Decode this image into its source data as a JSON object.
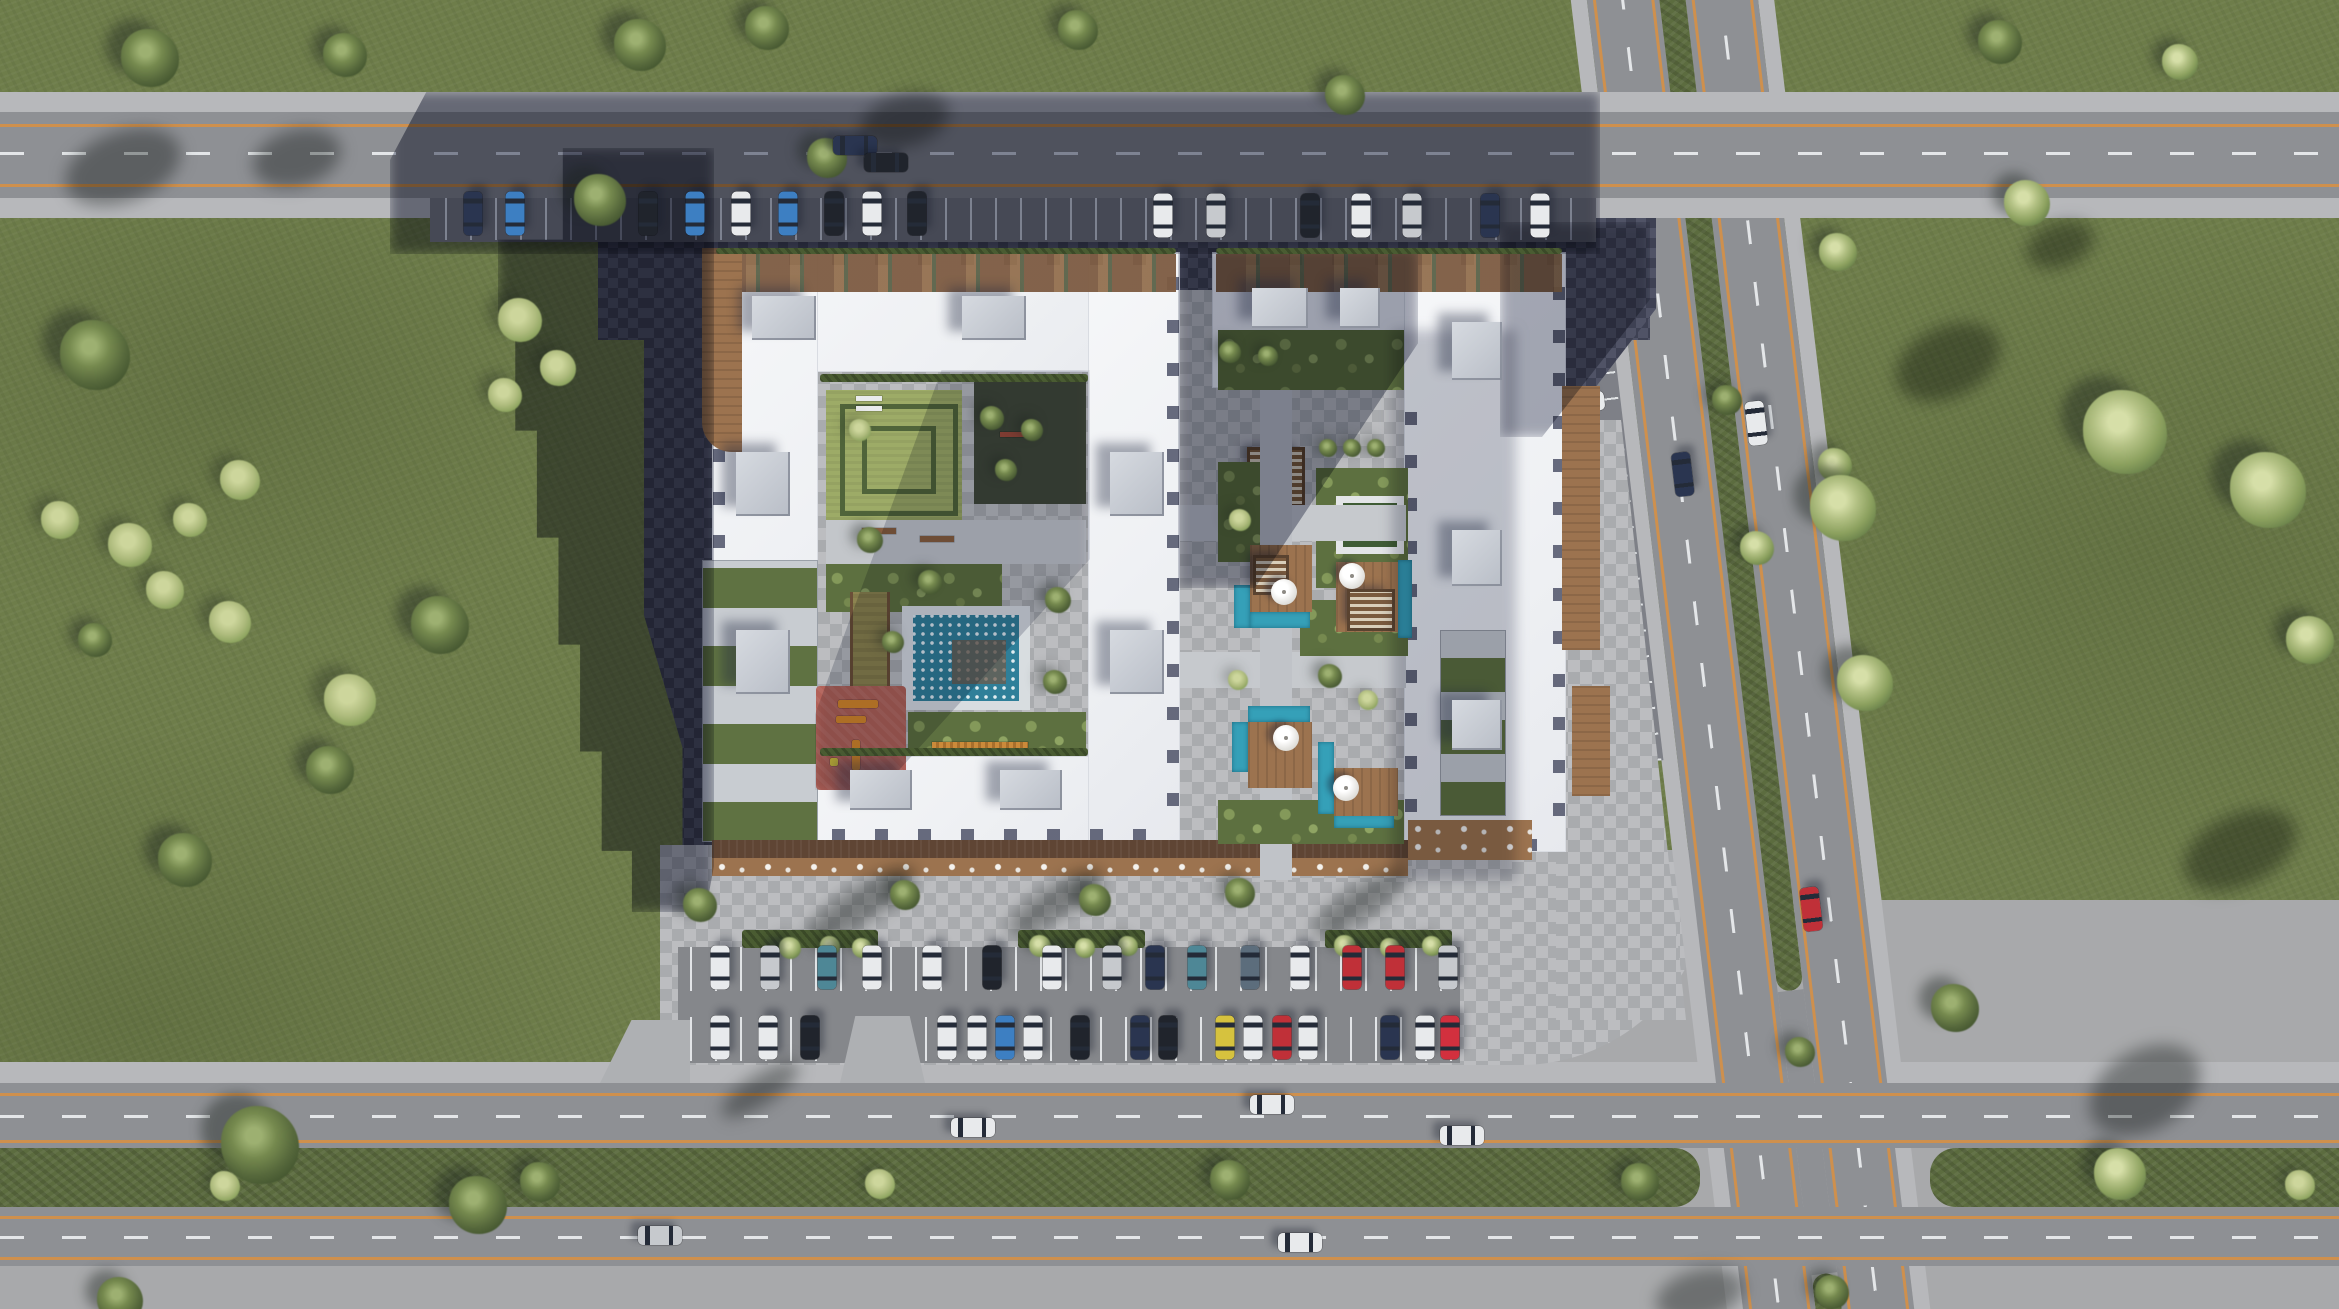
{
  "scene": {
    "description": "aerial top-down architectural render of a residential complex with two white-roofed perimeter buildings, landscaped courtyards with pools and playground, surface parking lots, and surrounding divided roads with green medians and lawns",
    "palette": {
      "grass": "#6e7d4a",
      "tree_dark": "#57693c",
      "tree_light": "#a3b273",
      "bush": "#c6cf92",
      "asphalt": "#8e9094",
      "line_orange": "#d59046",
      "line_white": "#edf0f2",
      "sidewalk": "#b7b8bb",
      "paver_light": "#b4b6b9",
      "paver_dark": "#45485c",
      "concrete": "#a8a9ab",
      "median_green": "#5c6c3f",
      "roof_white": "#f3f5f7",
      "roof_box": "#c8ccd3",
      "deck_wood": "#9c734f",
      "deck_dark": "#5f4534",
      "pool_water": "#2f7f99",
      "pool_bright": "#35a0b8",
      "hedge": "#4a5c32",
      "lawn": "#9dab67",
      "playground_red": "#b26158",
      "equipment_orange": "#d8882c",
      "track_olive": "#8d8450",
      "shadow_blue": "#272d48"
    },
    "trees": [
      {
        "x": 150,
        "y": 58,
        "s": 58,
        "t": "d"
      },
      {
        "x": 345,
        "y": 55,
        "s": 44,
        "t": "d"
      },
      {
        "x": 640,
        "y": 45,
        "s": 52,
        "t": "d"
      },
      {
        "x": 767,
        "y": 28,
        "s": 44,
        "t": "d"
      },
      {
        "x": 1078,
        "y": 30,
        "s": 40,
        "t": "d"
      },
      {
        "x": 1345,
        "y": 95,
        "s": 40,
        "t": "d"
      },
      {
        "x": 2000,
        "y": 42,
        "s": 44,
        "t": "d"
      },
      {
        "x": 2180,
        "y": 62,
        "s": 36,
        "t": "l"
      },
      {
        "x": 600,
        "y": 200,
        "s": 52,
        "t": "d"
      },
      {
        "x": 827,
        "y": 158,
        "s": 40,
        "t": "d"
      },
      {
        "x": 95,
        "y": 355,
        "s": 70,
        "t": "d"
      },
      {
        "x": 240,
        "y": 480,
        "s": 40,
        "t": "b"
      },
      {
        "x": 60,
        "y": 520,
        "s": 38,
        "t": "b"
      },
      {
        "x": 130,
        "y": 545,
        "s": 44,
        "t": "b"
      },
      {
        "x": 190,
        "y": 520,
        "s": 34,
        "t": "b"
      },
      {
        "x": 165,
        "y": 590,
        "s": 38,
        "t": "b"
      },
      {
        "x": 230,
        "y": 622,
        "s": 42,
        "t": "b"
      },
      {
        "x": 350,
        "y": 700,
        "s": 52,
        "t": "b"
      },
      {
        "x": 95,
        "y": 640,
        "s": 34,
        "t": "d"
      },
      {
        "x": 440,
        "y": 625,
        "s": 58,
        "t": "d"
      },
      {
        "x": 330,
        "y": 770,
        "s": 48,
        "t": "d"
      },
      {
        "x": 185,
        "y": 860,
        "s": 54,
        "t": "d"
      },
      {
        "x": 520,
        "y": 320,
        "s": 44,
        "t": "b"
      },
      {
        "x": 558,
        "y": 368,
        "s": 36,
        "t": "b"
      },
      {
        "x": 505,
        "y": 395,
        "s": 34,
        "t": "b"
      },
      {
        "x": 260,
        "y": 1145,
        "s": 78,
        "t": "d"
      },
      {
        "x": 478,
        "y": 1205,
        "s": 58,
        "t": "d"
      },
      {
        "x": 120,
        "y": 1300,
        "s": 46,
        "t": "d"
      },
      {
        "x": 2027,
        "y": 203,
        "s": 46,
        "t": "l"
      },
      {
        "x": 1838,
        "y": 252,
        "s": 38,
        "t": "l"
      },
      {
        "x": 1835,
        "y": 465,
        "s": 34,
        "t": "l"
      },
      {
        "x": 2125,
        "y": 432,
        "s": 84,
        "t": "l"
      },
      {
        "x": 2268,
        "y": 490,
        "s": 76,
        "t": "l"
      },
      {
        "x": 2310,
        "y": 640,
        "s": 48,
        "t": "l"
      },
      {
        "x": 1843,
        "y": 508,
        "s": 66,
        "t": "l"
      },
      {
        "x": 1865,
        "y": 683,
        "s": 56,
        "t": "l"
      },
      {
        "x": 1955,
        "y": 1008,
        "s": 48,
        "t": "d"
      },
      {
        "x": 225,
        "y": 1186,
        "s": 30,
        "t": "b"
      },
      {
        "x": 540,
        "y": 1182,
        "s": 40,
        "t": "d"
      },
      {
        "x": 880,
        "y": 1184,
        "s": 30,
        "t": "b"
      },
      {
        "x": 1230,
        "y": 1180,
        "s": 40,
        "t": "d"
      },
      {
        "x": 1640,
        "y": 1182,
        "s": 38,
        "t": "d"
      },
      {
        "x": 2120,
        "y": 1174,
        "s": 52,
        "t": "l"
      },
      {
        "x": 2300,
        "y": 1185,
        "s": 30,
        "t": "b"
      },
      {
        "x": 1727,
        "y": 400,
        "s": 30,
        "t": "d"
      },
      {
        "x": 1757,
        "y": 548,
        "s": 34,
        "t": "l"
      },
      {
        "x": 1800,
        "y": 1052,
        "s": 30,
        "t": "d"
      },
      {
        "x": 1832,
        "y": 1292,
        "s": 34,
        "t": "d"
      },
      {
        "x": 700,
        "y": 905,
        "s": 34,
        "t": "d"
      },
      {
        "x": 905,
        "y": 895,
        "s": 30,
        "t": "d"
      },
      {
        "x": 1095,
        "y": 900,
        "s": 32,
        "t": "d"
      },
      {
        "x": 1240,
        "y": 893,
        "s": 30,
        "t": "d"
      },
      {
        "x": 790,
        "y": 948,
        "s": 22,
        "t": "l"
      },
      {
        "x": 830,
        "y": 946,
        "s": 20,
        "t": "l"
      },
      {
        "x": 862,
        "y": 948,
        "s": 20,
        "t": "l"
      },
      {
        "x": 1040,
        "y": 946,
        "s": 22,
        "t": "l"
      },
      {
        "x": 1085,
        "y": 948,
        "s": 20,
        "t": "l"
      },
      {
        "x": 1128,
        "y": 946,
        "s": 20,
        "t": "l"
      },
      {
        "x": 1345,
        "y": 946,
        "s": 22,
        "t": "l"
      },
      {
        "x": 1390,
        "y": 948,
        "s": 20,
        "t": "l"
      },
      {
        "x": 1432,
        "y": 946,
        "s": 20,
        "t": "l"
      },
      {
        "x": 870,
        "y": 540,
        "s": 26,
        "t": "d"
      },
      {
        "x": 930,
        "y": 582,
        "s": 24,
        "t": "d"
      },
      {
        "x": 1058,
        "y": 600,
        "s": 26,
        "t": "d"
      },
      {
        "x": 1055,
        "y": 682,
        "s": 24,
        "t": "d"
      },
      {
        "x": 893,
        "y": 642,
        "s": 22,
        "t": "d"
      },
      {
        "x": 992,
        "y": 418,
        "s": 24,
        "t": "d"
      },
      {
        "x": 1032,
        "y": 430,
        "s": 22,
        "t": "d"
      },
      {
        "x": 1006,
        "y": 470,
        "s": 22,
        "t": "d"
      },
      {
        "x": 860,
        "y": 430,
        "s": 22,
        "t": "b"
      },
      {
        "x": 1230,
        "y": 352,
        "s": 22,
        "t": "d"
      },
      {
        "x": 1268,
        "y": 356,
        "s": 20,
        "t": "d"
      },
      {
        "x": 1352,
        "y": 448,
        "s": 18,
        "t": "d"
      },
      {
        "x": 1376,
        "y": 448,
        "s": 18,
        "t": "d"
      },
      {
        "x": 1328,
        "y": 448,
        "s": 18,
        "t": "d"
      },
      {
        "x": 1240,
        "y": 520,
        "s": 22,
        "t": "b"
      },
      {
        "x": 1330,
        "y": 676,
        "s": 24,
        "t": "d"
      },
      {
        "x": 1238,
        "y": 680,
        "s": 20,
        "t": "b"
      },
      {
        "x": 1368,
        "y": 700,
        "s": 20,
        "t": "b"
      }
    ],
    "shadow_blobs": [
      {
        "x": 123,
        "y": 167,
        "w": 120,
        "h": 70,
        "r": -20
      },
      {
        "x": 297,
        "y": 158,
        "w": 90,
        "h": 56,
        "r": -15
      },
      {
        "x": 905,
        "y": 120,
        "w": 90,
        "h": 52,
        "r": -15
      },
      {
        "x": 1948,
        "y": 362,
        "w": 110,
        "h": 70,
        "r": -25
      },
      {
        "x": 2060,
        "y": 245,
        "w": 70,
        "h": 44,
        "r": -20
      },
      {
        "x": 2145,
        "y": 1090,
        "w": 120,
        "h": 80,
        "r": -30
      },
      {
        "x": 1700,
        "y": 1295,
        "w": 90,
        "h": 50,
        "r": -15
      },
      {
        "x": 860,
        "y": 905,
        "w": 130,
        "h": 36,
        "r": -33
      },
      {
        "x": 1055,
        "y": 902,
        "w": 110,
        "h": 32,
        "r": -33
      },
      {
        "x": 1360,
        "y": 903,
        "w": 110,
        "h": 32,
        "r": -33
      },
      {
        "x": 760,
        "y": 1090,
        "w": 90,
        "h": 30,
        "r": -33
      },
      {
        "x": 2240,
        "y": 850,
        "w": 120,
        "h": 70,
        "r": -25
      }
    ],
    "bulkheads": [
      {
        "x": 752,
        "y": 296,
        "w": 64,
        "h": 44
      },
      {
        "x": 962,
        "y": 296,
        "w": 64,
        "h": 44
      },
      {
        "x": 736,
        "y": 452,
        "w": 54,
        "h": 64
      },
      {
        "x": 736,
        "y": 630,
        "w": 54,
        "h": 64
      },
      {
        "x": 1110,
        "y": 452,
        "w": 54,
        "h": 64
      },
      {
        "x": 1110,
        "y": 630,
        "w": 54,
        "h": 64
      },
      {
        "x": 850,
        "y": 770,
        "w": 62,
        "h": 40
      },
      {
        "x": 1000,
        "y": 770,
        "w": 62,
        "h": 40
      },
      {
        "x": 1252,
        "y": 288,
        "w": 56,
        "h": 40
      },
      {
        "x": 1340,
        "y": 288,
        "w": 40,
        "h": 40
      },
      {
        "x": 1452,
        "y": 322,
        "w": 50,
        "h": 58
      },
      {
        "x": 1452,
        "y": 530,
        "w": 50,
        "h": 56
      },
      {
        "x": 1452,
        "y": 700,
        "w": 50,
        "h": 50
      }
    ],
    "umbrellas": [
      {
        "x": 1284,
        "y": 592
      },
      {
        "x": 1352,
        "y": 576
      },
      {
        "x": 1286,
        "y": 738
      },
      {
        "x": 1346,
        "y": 788
      }
    ],
    "hedges": [
      {
        "x": 742,
        "y": 930,
        "w": 136,
        "h": 18
      },
      {
        "x": 1018,
        "y": 930,
        "w": 127,
        "h": 18
      },
      {
        "x": 1325,
        "y": 930,
        "w": 127,
        "h": 18
      },
      {
        "x": 820,
        "y": 374,
        "w": 268,
        "h": 8
      },
      {
        "x": 820,
        "y": 748,
        "w": 268,
        "h": 8
      },
      {
        "x": 716,
        "y": 248,
        "w": 460,
        "h": 6
      },
      {
        "x": 1216,
        "y": 248,
        "w": 346,
        "h": 6
      }
    ],
    "cars": {
      "colors": {
        "white": "#e8eaec",
        "silver": "#c6c9cd",
        "black": "#20242c",
        "navy": "#2a3550",
        "blue": "#3d7fc2",
        "teal": "#4e8796",
        "red": "#c03038",
        "crimson": "#d2303e",
        "yellow": "#d6c23e",
        "steel": "#5c6d7c",
        "green": "#3f6b52",
        "gray": "#8a8f96"
      },
      "static": [
        {
          "x": 473,
          "y": 214,
          "o": 90,
          "c": "navy"
        },
        {
          "x": 515,
          "y": 214,
          "o": 90,
          "c": "blue"
        },
        {
          "x": 648,
          "y": 214,
          "o": 90,
          "c": "black"
        },
        {
          "x": 695,
          "y": 214,
          "o": 90,
          "c": "blue"
        },
        {
          "x": 741,
          "y": 214,
          "o": 90,
          "c": "white"
        },
        {
          "x": 788,
          "y": 214,
          "o": 90,
          "c": "blue"
        },
        {
          "x": 834,
          "y": 214,
          "o": 90,
          "c": "black"
        },
        {
          "x": 872,
          "y": 214,
          "o": 90,
          "c": "white"
        },
        {
          "x": 917,
          "y": 214,
          "o": 90,
          "c": "black"
        },
        {
          "x": 1163,
          "y": 216,
          "o": 90,
          "c": "white"
        },
        {
          "x": 1216,
          "y": 216,
          "o": 90,
          "c": "silver"
        },
        {
          "x": 1310,
          "y": 216,
          "o": 90,
          "c": "black"
        },
        {
          "x": 1361,
          "y": 216,
          "o": 90,
          "c": "white"
        },
        {
          "x": 1412,
          "y": 216,
          "o": 90,
          "c": "silver"
        },
        {
          "x": 1490,
          "y": 216,
          "o": 90,
          "c": "navy"
        },
        {
          "x": 1540,
          "y": 216,
          "o": 90,
          "c": "white"
        },
        {
          "x": 855,
          "y": 146,
          "o": 0,
          "c": "navy"
        },
        {
          "x": 886,
          "y": 163,
          "o": 0,
          "c": "black"
        },
        {
          "x": 720,
          "y": 968,
          "o": 90,
          "c": "white"
        },
        {
          "x": 770,
          "y": 968,
          "o": 90,
          "c": "silver"
        },
        {
          "x": 827,
          "y": 968,
          "o": 90,
          "c": "teal"
        },
        {
          "x": 872,
          "y": 968,
          "o": 90,
          "c": "white"
        },
        {
          "x": 932,
          "y": 968,
          "o": 90,
          "c": "white"
        },
        {
          "x": 992,
          "y": 968,
          "o": 90,
          "c": "black"
        },
        {
          "x": 1052,
          "y": 968,
          "o": 90,
          "c": "white"
        },
        {
          "x": 1112,
          "y": 968,
          "o": 90,
          "c": "silver"
        },
        {
          "x": 1155,
          "y": 968,
          "o": 90,
          "c": "navy"
        },
        {
          "x": 1197,
          "y": 968,
          "o": 90,
          "c": "teal"
        },
        {
          "x": 1250,
          "y": 968,
          "o": 90,
          "c": "steel"
        },
        {
          "x": 1300,
          "y": 968,
          "o": 90,
          "c": "white"
        },
        {
          "x": 1352,
          "y": 968,
          "o": 90,
          "c": "red"
        },
        {
          "x": 1395,
          "y": 968,
          "o": 90,
          "c": "red"
        },
        {
          "x": 1448,
          "y": 968,
          "o": 90,
          "c": "silver"
        },
        {
          "x": 720,
          "y": 1038,
          "o": 90,
          "c": "white"
        },
        {
          "x": 768,
          "y": 1038,
          "o": 90,
          "c": "white"
        },
        {
          "x": 810,
          "y": 1038,
          "o": 90,
          "c": "black"
        },
        {
          "x": 947,
          "y": 1038,
          "o": 90,
          "c": "white"
        },
        {
          "x": 977,
          "y": 1038,
          "o": 90,
          "c": "white"
        },
        {
          "x": 1005,
          "y": 1038,
          "o": 90,
          "c": "blue"
        },
        {
          "x": 1033,
          "y": 1038,
          "o": 90,
          "c": "white"
        },
        {
          "x": 1080,
          "y": 1038,
          "o": 90,
          "c": "black"
        },
        {
          "x": 1140,
          "y": 1038,
          "o": 90,
          "c": "navy"
        },
        {
          "x": 1168,
          "y": 1038,
          "o": 90,
          "c": "black"
        },
        {
          "x": 1225,
          "y": 1038,
          "o": 90,
          "c": "yellow"
        },
        {
          "x": 1253,
          "y": 1038,
          "o": 90,
          "c": "white"
        },
        {
          "x": 1282,
          "y": 1038,
          "o": 90,
          "c": "red"
        },
        {
          "x": 1308,
          "y": 1038,
          "o": 90,
          "c": "white"
        },
        {
          "x": 1390,
          "y": 1038,
          "o": 90,
          "c": "navy"
        },
        {
          "x": 1425,
          "y": 1038,
          "o": 90,
          "c": "white"
        },
        {
          "x": 1450,
          "y": 1038,
          "o": 90,
          "c": "crimson"
        },
        {
          "x": 973,
          "y": 1128,
          "o": 0,
          "c": "white"
        },
        {
          "x": 1272,
          "y": 1105,
          "o": 0,
          "c": "white"
        },
        {
          "x": 1462,
          "y": 1136,
          "o": 0,
          "c": "white"
        },
        {
          "x": 1300,
          "y": 1243,
          "o": 0,
          "c": "white"
        },
        {
          "x": 660,
          "y": 1236,
          "o": 0,
          "c": "silver"
        }
      ],
      "vgroup": [
        {
          "x": -36,
          "y": 310,
          "o": 0,
          "c": "gray"
        },
        {
          "x": -36,
          "y": 355,
          "o": 0,
          "c": "white"
        },
        {
          "x": -36,
          "y": 398,
          "o": 0,
          "c": "red"
        },
        {
          "x": -36,
          "y": 442,
          "o": 0,
          "c": "white"
        },
        {
          "x": -36,
          "y": 512,
          "o": 0,
          "c": "white"
        },
        {
          "x": -36,
          "y": 582,
          "o": 0,
          "c": "red"
        },
        {
          "x": -36,
          "y": 632,
          "o": 0,
          "c": "teal"
        },
        {
          "x": -36,
          "y": 682,
          "o": 0,
          "c": "white"
        },
        {
          "x": -36,
          "y": 732,
          "o": 0,
          "c": "white"
        },
        {
          "x": -36,
          "y": 772,
          "o": 0,
          "c": "black"
        },
        {
          "x": -36,
          "y": 828,
          "o": 0,
          "c": "white"
        },
        {
          "x": -36,
          "y": 856,
          "o": 0,
          "c": "black"
        },
        {
          "x": 134,
          "y": 483,
          "o": 90,
          "c": "white"
        },
        {
          "x": 55,
          "y": 525,
          "o": 90,
          "c": "navy"
        },
        {
          "x": 131,
          "y": 972,
          "o": 90,
          "c": "red"
        }
      ]
    }
  }
}
